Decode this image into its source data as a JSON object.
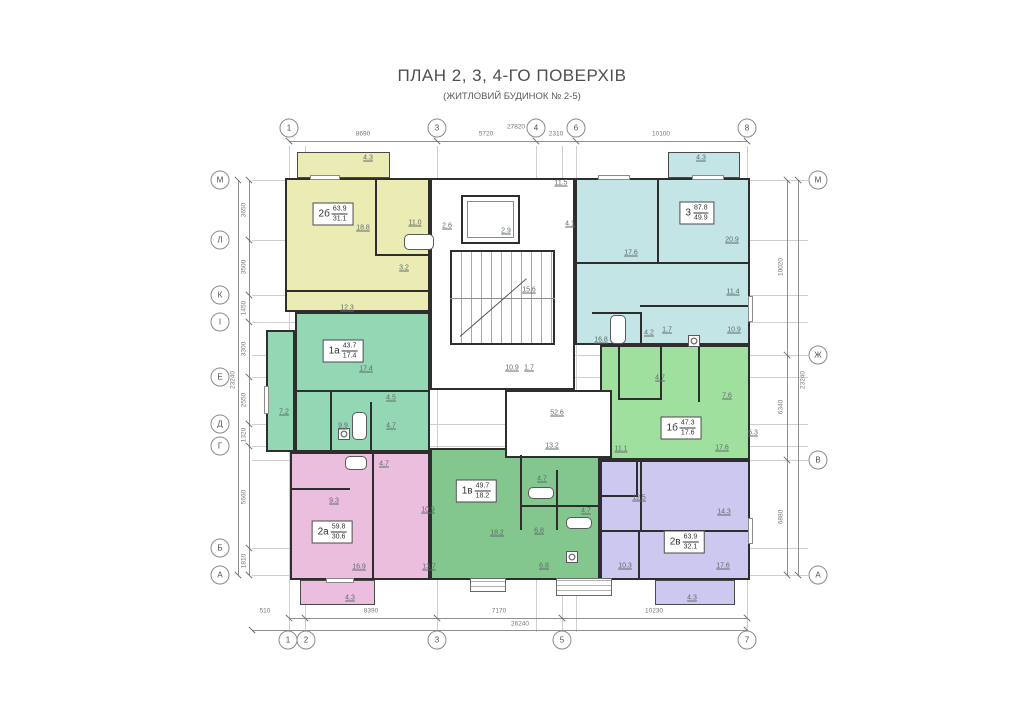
{
  "title": "ПЛАН 2, 3, 4-ГО ПОВЕРХІВ",
  "subtitle": "(ЖИТЛОВИЙ БУДИНОК № 2-5)",
  "axes": {
    "top": {
      "labels": [
        "1",
        "3",
        "4",
        "6",
        "8"
      ],
      "dims": [
        "8690",
        "5720",
        "2310",
        "10100"
      ],
      "total": "27820"
    },
    "bottom": {
      "labels": [
        "1",
        "2",
        "3",
        "5",
        "7"
      ],
      "dims": [
        "510",
        "8390",
        "7170",
        "10230"
      ],
      "total": "26240"
    },
    "left": {
      "labels": [
        "М",
        "Л",
        "К",
        "І",
        "Е",
        "Д",
        "Г",
        "Б",
        "А"
      ],
      "dims": [
        "3650",
        "3500",
        "1450",
        "3300",
        "2550",
        "1320",
        "5660",
        "1810"
      ],
      "total": "23240"
    },
    "right": {
      "labels": [
        "М",
        "Ж",
        "В",
        "А"
      ],
      "dims": [
        "10020",
        "6340",
        "6880"
      ],
      "total": "23240"
    }
  },
  "apartments": [
    {
      "id": "2b",
      "code": "2б",
      "area_total": "63.9",
      "area_living": "31.1",
      "color": "#ebecb4"
    },
    {
      "id": "3",
      "code": "3",
      "area_total": "87.8",
      "area_living": "49.9",
      "color": "#c3e5e6"
    },
    {
      "id": "1a",
      "code": "1а",
      "area_total": "43.7",
      "area_living": "17.4",
      "color": "#93d7b4"
    },
    {
      "id": "1b",
      "code": "1б",
      "area_total": "47.3",
      "area_living": "17.6",
      "color": "#9fe09f"
    },
    {
      "id": "2a",
      "code": "2а",
      "area_total": "59.8",
      "area_living": "30.6",
      "color": "#ecbede"
    },
    {
      "id": "1v",
      "code": "1в",
      "area_total": "49.7",
      "area_living": "18.2",
      "color": "#84c78e"
    },
    {
      "id": "2v",
      "code": "2в",
      "area_total": "63.9",
      "area_living": "32.1",
      "color": "#cdc8ef"
    }
  ],
  "room_labels": [
    "4.3",
    "18.8",
    "11.0",
    "3.2",
    "12.3",
    "2.6",
    "2.9",
    "11.5",
    "4.1",
    "15.6",
    "4.3",
    "17.6",
    "20.9",
    "11.4",
    "10.9",
    "16.8",
    "4.2",
    "1.7",
    "17.4",
    "4.5",
    "7.2",
    "9.9",
    "4.7",
    "10.9",
    "1.7",
    "52.6",
    "13.2",
    "4.7",
    "7.6",
    "11.1",
    "6.3",
    "17.6",
    "9.3",
    "10.9",
    "4.7",
    "16.9",
    "13.7",
    "4.3",
    "4.7",
    "18.2",
    "6.8",
    "4.7",
    "6.8",
    "12.5",
    "14.3",
    "10.3",
    "17.6",
    "4.3"
  ]
}
